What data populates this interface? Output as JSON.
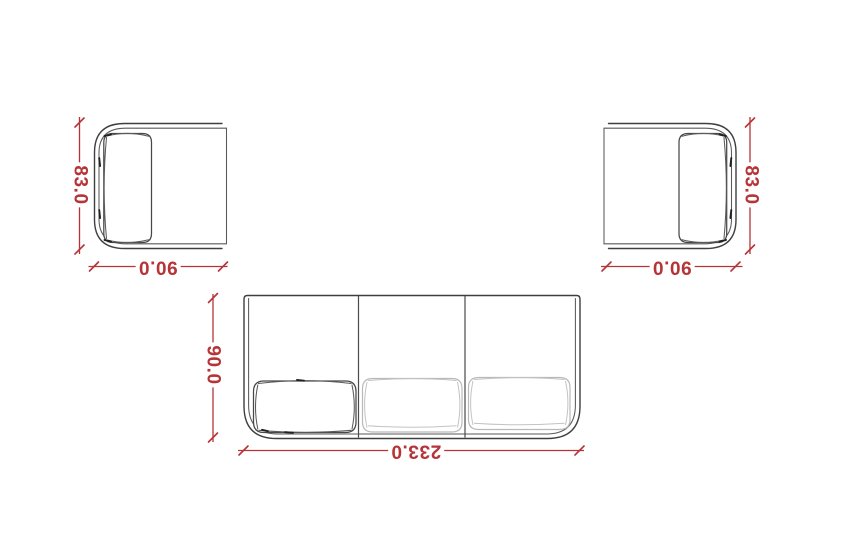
{
  "drawing": {
    "type": "furniture-top-view-dimension-plan",
    "background": "#ffffff",
    "colors": {
      "dimension_red": "#b63437",
      "outline_dark": "#3f3f3f",
      "outline_light": "#b9b9b9"
    },
    "furniture": {
      "armchair_left": {
        "name": "armchair-left",
        "depth_label": "83.0",
        "width_label": "90.0"
      },
      "armchair_right": {
        "name": "armchair-right",
        "depth_label": "83.0",
        "width_label": "90.0"
      },
      "sofa": {
        "name": "three-seat-sofa",
        "depth_label": "90.0",
        "width_label": "233.0"
      }
    }
  }
}
